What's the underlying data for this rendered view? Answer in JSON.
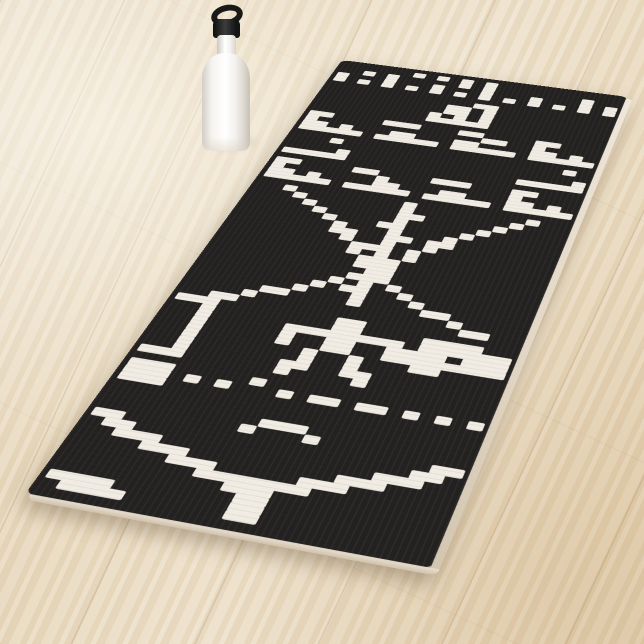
{
  "scene": {
    "type": "product-photo",
    "subject": "yoga mat with black-and-white pixel-art Arecibo message design",
    "props": [
      "white sport water bottle with black loop cap"
    ],
    "background": "light oak wood plank floor"
  },
  "palette": {
    "floor_light": "#eee2cc",
    "floor_mid": "#e7d8bd",
    "floor_seam": "#c7b291",
    "mat_black": "#242221",
    "pixel_white": "#f1ece3",
    "mat_edge_light": "#efe7da",
    "mat_edge_dark": "#cfc2ac",
    "bottle_white": "#ffffff",
    "bottle_cap_black": "#191918",
    "shadow": "rgba(98,76,52,0.38)"
  },
  "mat": {
    "design_name": "arecibo-message-pixel-art",
    "grid_cols": 23,
    "grid_rows": 73,
    "bitmap_rows": [
      "00000010101010000000000",
      "00101000001010000000100",
      "10001000100010001000101",
      "10101010101010101010101",
      "00000000000000000000000",
      "00000000000011000000000",
      "00000000001101000000000",
      "00000000001101000000000",
      "00000000010101000000000",
      "00000000011111000000000",
      "00000000000000000000000",
      "11000011100011000011000",
      "10000000000000110010000",
      "11010001100011000011010",
      "11111011111011111011111",
      "00000000000000000000000",
      "00010000000000000000010",
      "00000000000000000000000",
      "00001000000000000000001",
      "11111000000000000011111",
      "00000000000000000000000",
      "11000011000011100011000",
      "10000000100000000010000",
      "11010000110001100011010",
      "11111011111011111011111",
      "00000000000000000000000",
      "00100000000100000000100",
      "00010000000100000001000",
      "00001000000110000010000",
      "00000100000100000100000",
      "00000010001100001000000",
      "00000001000100010000000",
      "00000001100110110000000",
      "00000000100100100000000",
      "00000000011101000000000",
      "00000000010101000000000",
      "00000000001110000000000",
      "00000000001110000000000",
      "00000000000110000000000",
      "00000000001110000000000",
      "00000000010101000000000",
      "00000000101100100000000",
      "00000001000100010000000",
      "00000110000100001100000",
      "00001000000000000010000",
      "00110000000000000001100",
      "11100000000110000000000",
      "00100000000110000111100",
      "00100000111111110111111",
      "00100000100110011110111",
      "00100000100110011111111",
      "00100000001001000110000",
      "00100000001001000000000",
      "00100000011001100000000",
      "11100000010000100000000",
      "00000000000000000000000",
      "11100000100000000000000",
      "11101010001011011010101",
      "11100000000000000000000",
      "00000000000000000000000",
      "00000000000000000000000",
      "00000000001110000000000",
      "00000000010001000000000",
      "11000000000000000000011",
      "01100000000000000000110",
      "00111000000000000011100",
      "00001110000000001110000",
      "00000011100000111000000",
      "00000000111111100000000",
      "00000000001110000000000",
      "00000000000110000000000",
      "11110000000110000000000",
      "01111000000110000000000",
      "00000000000000000000000"
    ]
  },
  "bottle": {
    "style": "stainless sport water bottle",
    "cap": "black carabiner loop cap"
  }
}
